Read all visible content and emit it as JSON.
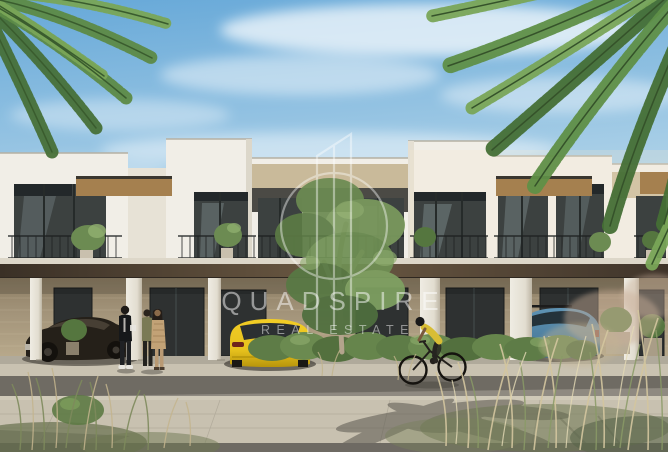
{
  "watermark": {
    "brand": "QUADSPIRE",
    "tagline": "REAL ESTATE",
    "logo": "drop-spire-icon",
    "color": "#ffffff"
  },
  "scene": {
    "subject": "Modern two-storey townhouse row with covered parking colonnade",
    "time_of_day": "day",
    "objects": [
      "blue sky with wispy clouds",
      "palm fronds top-left and top-right",
      "white flat-roof townhouse facade with wood soffits",
      "dark framed floor-to-ceiling windows",
      "black balcony railings with potted plants",
      "dark canopy over ground-floor colonnade with white columns",
      "stone-clad ground floor with glass doors",
      "dark sports car",
      "yellow hatchback",
      "blue SUV",
      "three pedestrians talking",
      "cyclist in yellow shirt",
      "central green tree",
      "shrub bed and ornamental grasses",
      "paved sidewalk, road and plaza with palm shadows"
    ]
  },
  "colors": {
    "sky_top": "#66a8d8",
    "sky_mid": "#a9cfe7",
    "sky_low": "#dbe8ee",
    "facade": "#f1eee7",
    "facade_shade": "#ddd7c9",
    "stone": "#c9ba9a",
    "soffit_wood": "#a5804f",
    "canopy_dark": "#4a3c2e",
    "window_dark": "#3c4140",
    "window_frame": "#23282a",
    "railing": "#1d2020",
    "ground_wall": "#a3947a",
    "column": "#efece3",
    "sidewalk": "#c9c2b1",
    "road": "#8f8a81",
    "shadow": "#55524b",
    "paving": "#c8c1b0",
    "bottom_band": "#6e6a63",
    "tree_green": "#6c8b52",
    "tree_green_dark": "#55763f",
    "tree_green_light": "#8fae6e",
    "palm_green": "#5d8a46",
    "palm_green_light": "#79a557",
    "palm_green_dark": "#477038",
    "grass_beige": "#d3c59e",
    "grass_green": "#8a9a66",
    "car_dark": "#252019",
    "car_yellow": "#e6c11d",
    "car_blue": "#5e93b4",
    "watermark_white": "#ffffff"
  }
}
